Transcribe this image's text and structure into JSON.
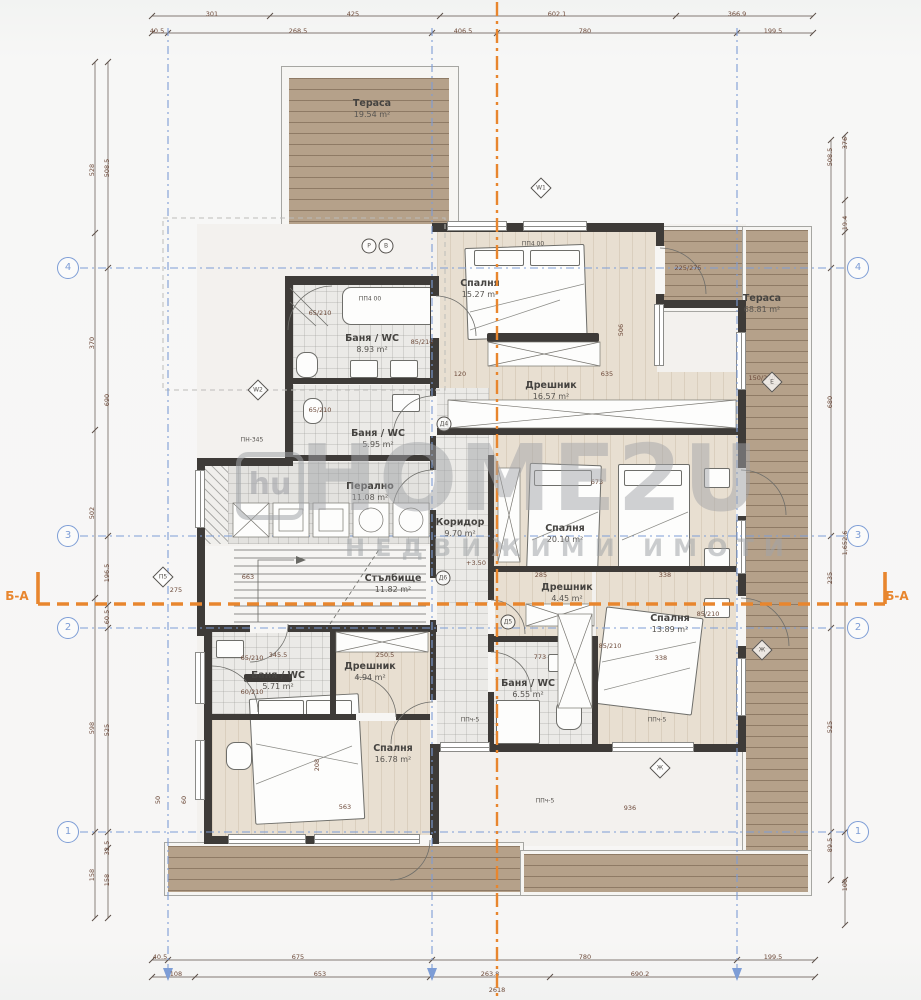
{
  "watermark": {
    "logo": "hu",
    "title": "HOME2U",
    "subtitle": "НЕДВИЖИМИ ИМОТИ"
  },
  "section": {
    "left": {
      "t": "Б-А",
      "x": 17,
      "y": 596
    },
    "right": {
      "t": "Б-А",
      "x": 897,
      "y": 596
    }
  },
  "axes": {
    "left_x": 68,
    "right_x": 858,
    "rows": [
      {
        "label": "4",
        "y": 268
      },
      {
        "label": "3",
        "y": 536
      },
      {
        "label": "2",
        "y": 628
      },
      {
        "label": "1",
        "y": 832
      }
    ]
  },
  "rooms": [
    {
      "id": "terrace-top",
      "name": "Тераса",
      "area": "19.54 m²",
      "x": 372,
      "y": 98
    },
    {
      "id": "bedroom-1",
      "name": "Спалня",
      "area": "15.27 m²",
      "x": 480,
      "y": 278
    },
    {
      "id": "bath-1",
      "name": "Баня / WC",
      "area": "8.93 m²",
      "x": 372,
      "y": 333
    },
    {
      "id": "bath-2",
      "name": "Баня / WC",
      "area": "5.95 m²",
      "x": 378,
      "y": 428
    },
    {
      "id": "dressing-1",
      "name": "Дрешник",
      "area": "16.57 m²",
      "x": 551,
      "y": 380
    },
    {
      "id": "terrace-right",
      "name": "Тераса",
      "area": "68.81 m²",
      "x": 762,
      "y": 293
    },
    {
      "id": "laundry",
      "name": "Перално",
      "area": "11.08 m²",
      "x": 370,
      "y": 481
    },
    {
      "id": "corridor",
      "name": "Коридор",
      "area": "9.70 m²",
      "x": 460,
      "y": 517
    },
    {
      "id": "bedroom-2",
      "name": "Спалня",
      "area": "20.10 m²",
      "x": 565,
      "y": 523
    },
    {
      "id": "staircase",
      "name": "Стълбище",
      "area": "11.82 m²",
      "x": 393,
      "y": 573
    },
    {
      "id": "dressing-2",
      "name": "Дрешник",
      "area": "4.45 m²",
      "x": 567,
      "y": 582
    },
    {
      "id": "bedroom-3",
      "name": "Спалня",
      "area": "13.89 m²",
      "x": 670,
      "y": 613
    },
    {
      "id": "bath-3",
      "name": "Баня / WC",
      "area": "6.55 m²",
      "x": 528,
      "y": 678
    },
    {
      "id": "bath-4",
      "name": "Баня / WC",
      "area": "5.71 m²",
      "x": 278,
      "y": 670
    },
    {
      "id": "dressing-3",
      "name": "Дрешник",
      "area": "4.94 m²",
      "x": 370,
      "y": 661
    },
    {
      "id": "bedroom-4",
      "name": "Спалня",
      "area": "16.78 m²",
      "x": 393,
      "y": 743
    }
  ],
  "dims": [
    {
      "t": "301",
      "x": 212,
      "y": 14
    },
    {
      "t": "425",
      "x": 353,
      "y": 14
    },
    {
      "t": "602.1",
      "x": 557,
      "y": 14
    },
    {
      "t": "366.9",
      "x": 737,
      "y": 14
    },
    {
      "t": "40.5",
      "x": 157,
      "y": 31
    },
    {
      "t": "268.5",
      "x": 298,
      "y": 31
    },
    {
      "t": "406.5",
      "x": 463,
      "y": 31
    },
    {
      "t": "780",
      "x": 585,
      "y": 31
    },
    {
      "t": "199.5",
      "x": 773,
      "y": 31
    },
    {
      "t": "40.5",
      "x": 160,
      "y": 957
    },
    {
      "t": "675",
      "x": 298,
      "y": 957
    },
    {
      "t": "780",
      "x": 585,
      "y": 957
    },
    {
      "t": "199.5",
      "x": 773,
      "y": 957
    },
    {
      "t": "108",
      "x": 176,
      "y": 974
    },
    {
      "t": "653",
      "x": 320,
      "y": 974
    },
    {
      "t": "263.8",
      "x": 490,
      "y": 974
    },
    {
      "t": "690.2",
      "x": 640,
      "y": 974
    },
    {
      "t": "2618",
      "x": 497,
      "y": 990
    },
    {
      "t": "528",
      "x": 92,
      "y": 170,
      "r": -90
    },
    {
      "t": "370",
      "x": 92,
      "y": 343,
      "r": -90
    },
    {
      "t": "502",
      "x": 92,
      "y": 513,
      "r": -90
    },
    {
      "t": "598",
      "x": 92,
      "y": 728,
      "r": -90
    },
    {
      "t": "158",
      "x": 92,
      "y": 875,
      "r": -90
    },
    {
      "t": "508.5",
      "x": 107,
      "y": 168,
      "r": -90
    },
    {
      "t": "690",
      "x": 107,
      "y": 400,
      "r": -90
    },
    {
      "t": "196.5",
      "x": 107,
      "y": 573,
      "r": -90
    },
    {
      "t": "60.5",
      "x": 107,
      "y": 617,
      "r": -90
    },
    {
      "t": "525",
      "x": 107,
      "y": 730,
      "r": -90
    },
    {
      "t": "32.5",
      "x": 107,
      "y": 848,
      "r": -90
    },
    {
      "t": "158",
      "x": 107,
      "y": 880,
      "r": -90
    },
    {
      "t": "508.5",
      "x": 830,
      "y": 157,
      "r": -90
    },
    {
      "t": "680",
      "x": 830,
      "y": 402,
      "r": -90
    },
    {
      "t": "235",
      "x": 830,
      "y": 578,
      "r": -90
    },
    {
      "t": "525",
      "x": 830,
      "y": 727,
      "r": -90
    },
    {
      "t": "89.5",
      "x": 830,
      "y": 845,
      "r": -90
    },
    {
      "t": "376",
      "x": 845,
      "y": 143,
      "r": -90
    },
    {
      "t": "19.4",
      "x": 845,
      "y": 223,
      "r": -90
    },
    {
      "t": "1,652.6",
      "x": 845,
      "y": 543,
      "r": -90
    },
    {
      "t": "100",
      "x": 845,
      "y": 885,
      "r": -90
    },
    {
      "t": "120",
      "x": 460,
      "y": 374
    },
    {
      "t": "635",
      "x": 607,
      "y": 374
    },
    {
      "t": "506",
      "x": 621,
      "y": 330,
      "r": -90
    },
    {
      "t": "285",
      "x": 541,
      "y": 575
    },
    {
      "t": "338",
      "x": 665,
      "y": 575
    },
    {
      "t": "773",
      "x": 540,
      "y": 657
    },
    {
      "t": "338",
      "x": 661,
      "y": 658
    },
    {
      "t": "345.5",
      "x": 278,
      "y": 655
    },
    {
      "t": "250.5",
      "x": 385,
      "y": 655
    },
    {
      "t": "563",
      "x": 345,
      "y": 807
    },
    {
      "t": "936",
      "x": 630,
      "y": 808
    },
    {
      "t": "663",
      "x": 248,
      "y": 577
    },
    {
      "t": "208",
      "x": 317,
      "y": 765,
      "r": -90
    },
    {
      "t": "673",
      "x": 597,
      "y": 482
    },
    {
      "t": "+3.50",
      "x": 476,
      "y": 563
    },
    {
      "t": "275",
      "x": 176,
      "y": 590
    },
    {
      "t": "65/210",
      "x": 320,
      "y": 313
    },
    {
      "t": "65/210",
      "x": 320,
      "y": 410
    },
    {
      "t": "85/210",
      "x": 422,
      "y": 342
    },
    {
      "t": "85/210",
      "x": 610,
      "y": 646
    },
    {
      "t": "85/210",
      "x": 708,
      "y": 614
    },
    {
      "t": "65/210",
      "x": 252,
      "y": 658
    },
    {
      "t": "60/210",
      "x": 252,
      "y": 692
    },
    {
      "t": "150/270",
      "x": 762,
      "y": 378
    },
    {
      "t": "225/275",
      "x": 688,
      "y": 268
    },
    {
      "t": "50",
      "x": 158,
      "y": 800,
      "r": -90
    },
    {
      "t": "60",
      "x": 184,
      "y": 800,
      "r": -90
    }
  ],
  "tags": [
    {
      "s": "d",
      "t": "W1",
      "x": 541,
      "y": 188
    },
    {
      "s": "d",
      "t": "W2",
      "x": 258,
      "y": 390
    },
    {
      "s": "c",
      "t": "Р",
      "x": 369,
      "y": 246
    },
    {
      "s": "c",
      "t": "В",
      "x": 386,
      "y": 246
    },
    {
      "s": "c",
      "t": "Д4",
      "x": 444,
      "y": 424
    },
    {
      "s": "c",
      "t": "Д5",
      "x": 508,
      "y": 622
    },
    {
      "s": "c",
      "t": "Д6",
      "x": 443,
      "y": 578
    },
    {
      "s": "d",
      "t": "П5",
      "x": 163,
      "y": 577
    },
    {
      "s": "d",
      "t": "Е",
      "x": 772,
      "y": 382
    },
    {
      "s": "d",
      "t": "Ж",
      "x": 762,
      "y": 650
    },
    {
      "s": "d",
      "t": "Ж",
      "x": 660,
      "y": 768
    },
    {
      "s": "t",
      "t": "ПП4 00",
      "x": 533,
      "y": 244
    },
    {
      "s": "t",
      "t": "ПП4 00",
      "x": 370,
      "y": 299
    },
    {
      "s": "t",
      "t": "ПН-345",
      "x": 252,
      "y": 440
    },
    {
      "s": "t",
      "t": "ППч-5",
      "x": 470,
      "y": 720
    },
    {
      "s": "t",
      "t": "ППч-5",
      "x": 657,
      "y": 720
    },
    {
      "s": "t",
      "t": "ППч-5",
      "x": 545,
      "y": 801
    }
  ]
}
